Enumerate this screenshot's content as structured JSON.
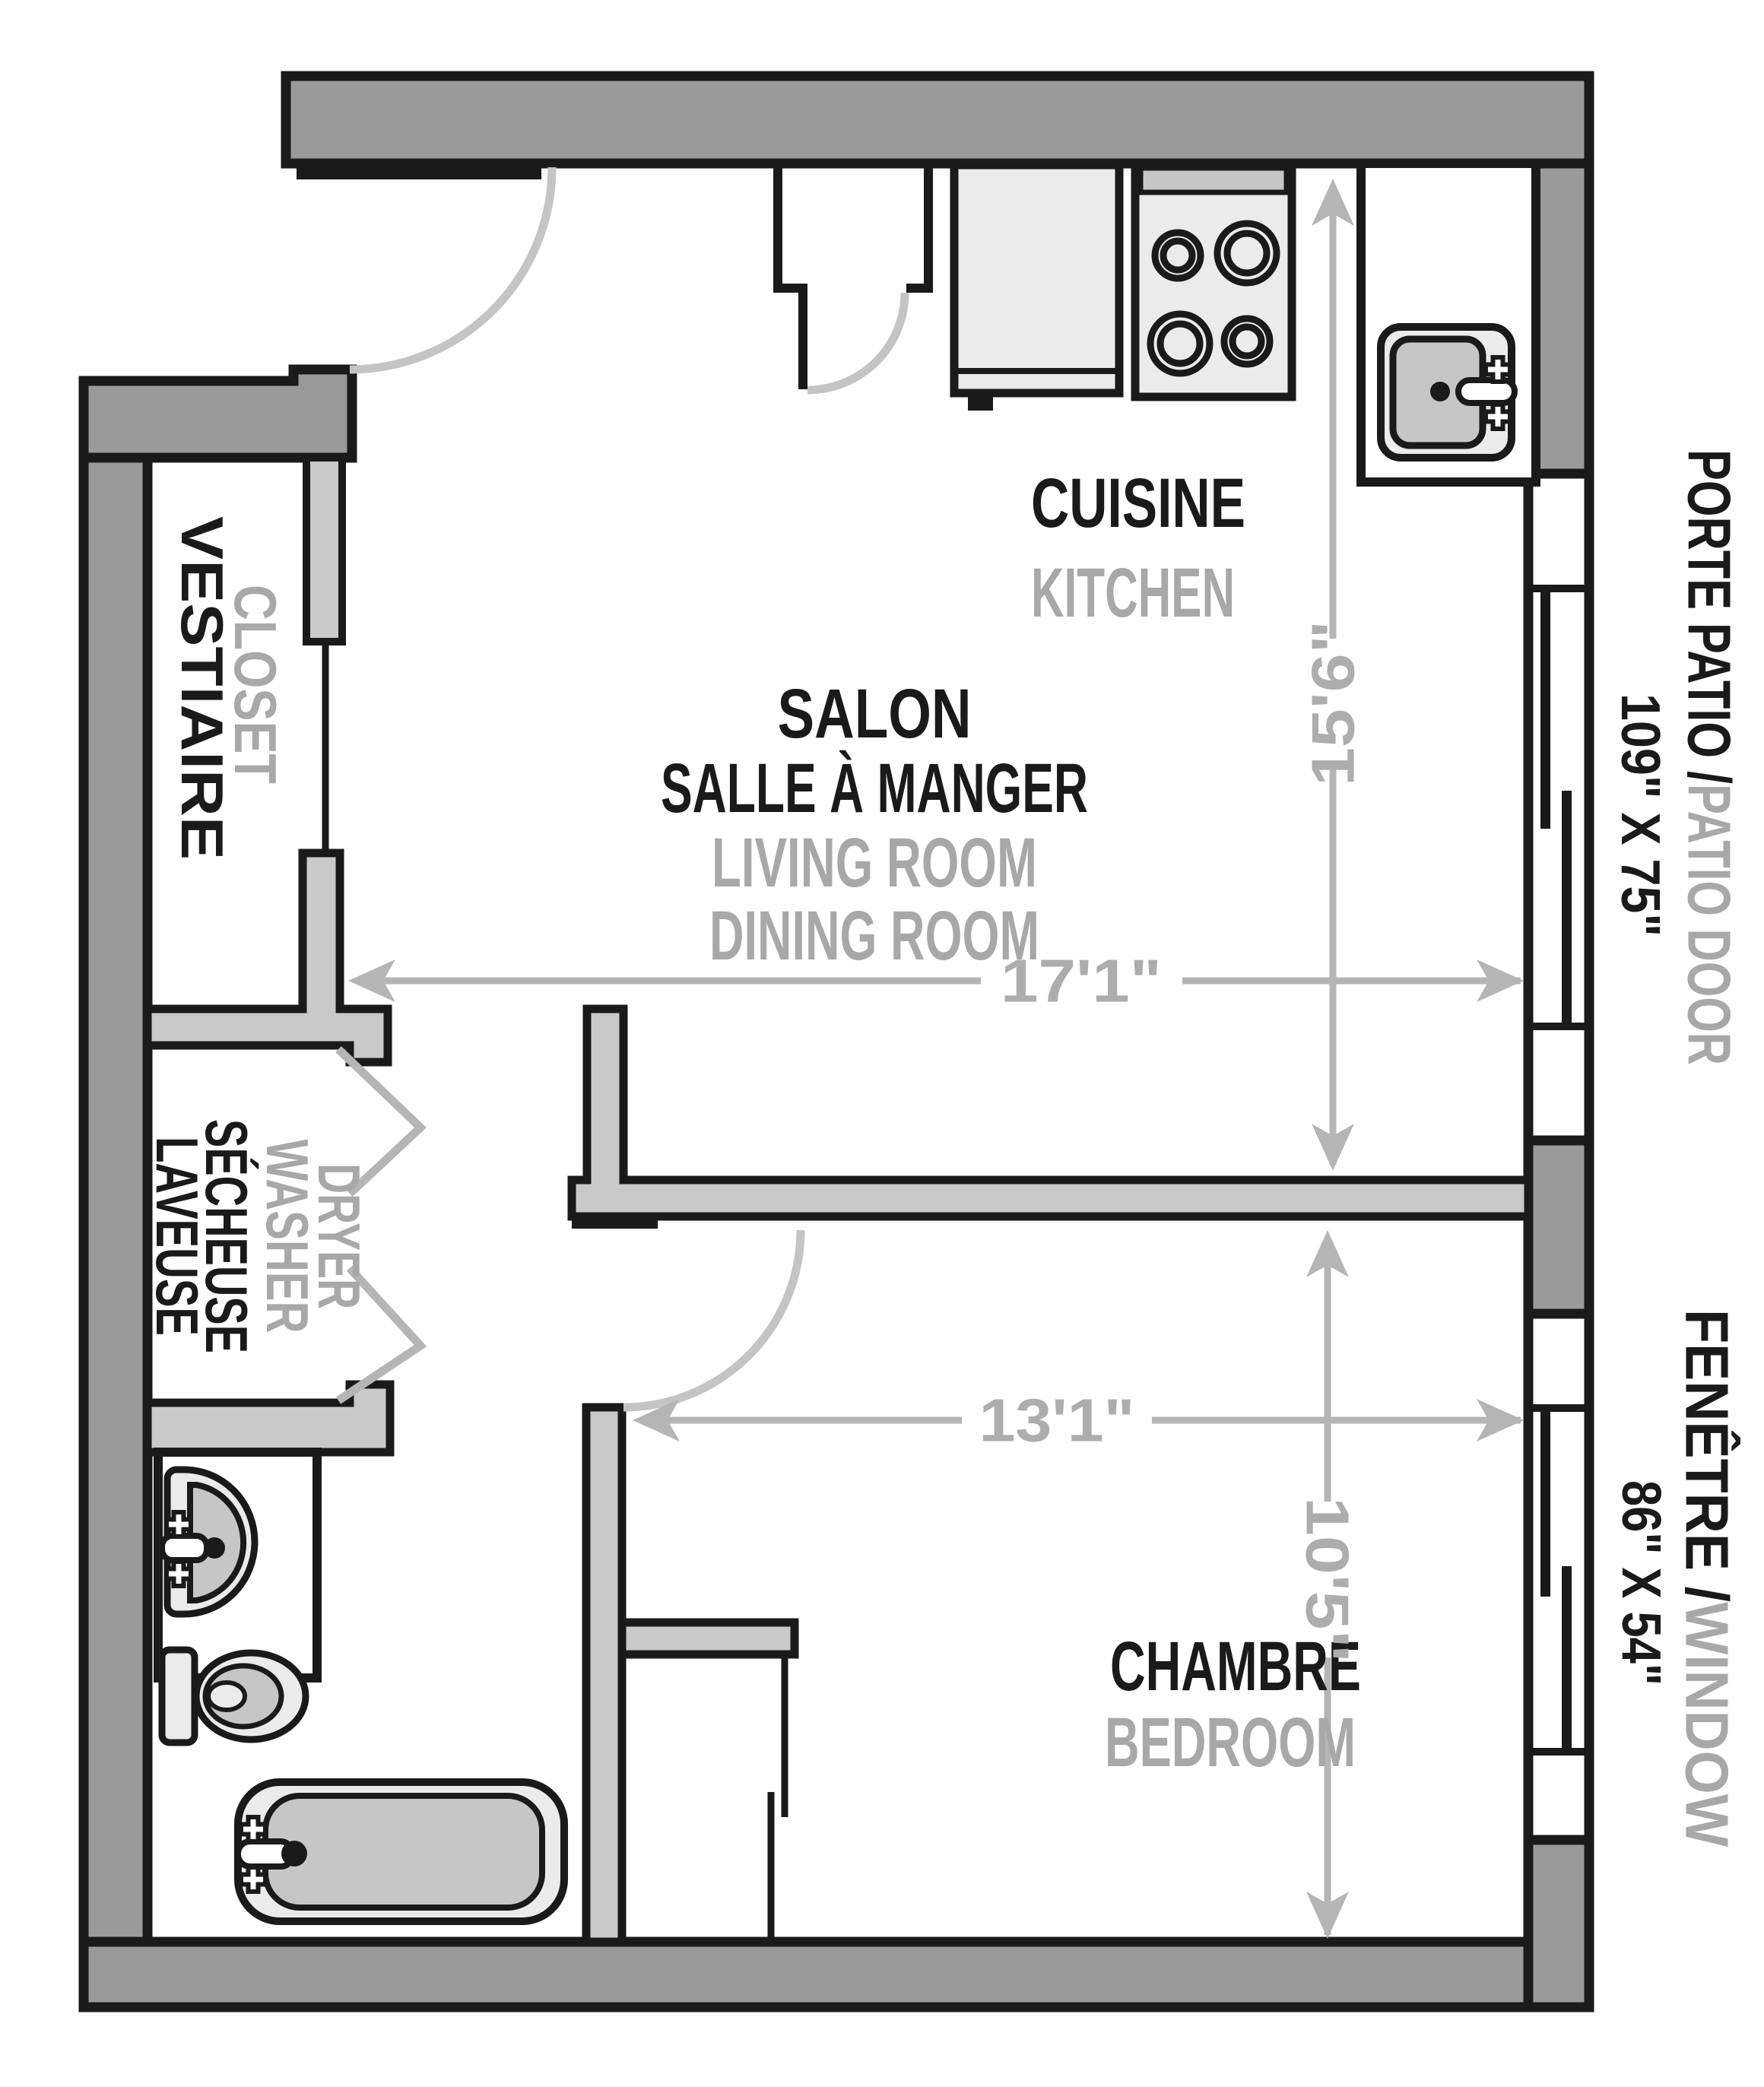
{
  "meta": {
    "type": "apartment floor plan"
  },
  "colors": {
    "wall_dark": "#9a9a9a",
    "wall_light": "#c9c9c9",
    "outline_black": "#1a1a1a",
    "fixture_light": "#ebebeb",
    "fixture_mid": "#c6c6c6",
    "dim_gray": "#b5b5b5",
    "label_gray": "#a8a8a8",
    "dim_text_gray": "#adadad"
  },
  "rooms": {
    "kitchen": {
      "label_fr": "CUISINE",
      "label_en": "KITCHEN"
    },
    "living_dining": {
      "line1_fr": "SALON",
      "line2_fr": "SALLE À MANGER",
      "line1_en": "LIVING ROOM",
      "line2_en": "DINING ROOM"
    },
    "closet": {
      "label_fr": "VESTIAIRE",
      "label_en": "CLOSET"
    },
    "laundry": {
      "line1_fr": "LAVEUSE",
      "line2_fr": "SÉCHEUSE",
      "line1_en": "WASHER",
      "line2_en": "DRYER"
    },
    "bedroom": {
      "label_fr": "CHAMBRE",
      "label_en": "BEDROOM"
    }
  },
  "dimensions": {
    "living_width": "17'1\"",
    "living_depth": "15'6\"",
    "bedroom_width": "13'1\"",
    "bedroom_depth": "10'5\""
  },
  "openings": {
    "patio_door": {
      "label_fr": "PORTE PATIO / ",
      "label_en": "PATIO DOOR",
      "size": "109\" X 75\""
    },
    "window": {
      "label_fr": "FENÊTRE / ",
      "label_en": "WINDOW",
      "size": "86\" X 54\""
    }
  }
}
